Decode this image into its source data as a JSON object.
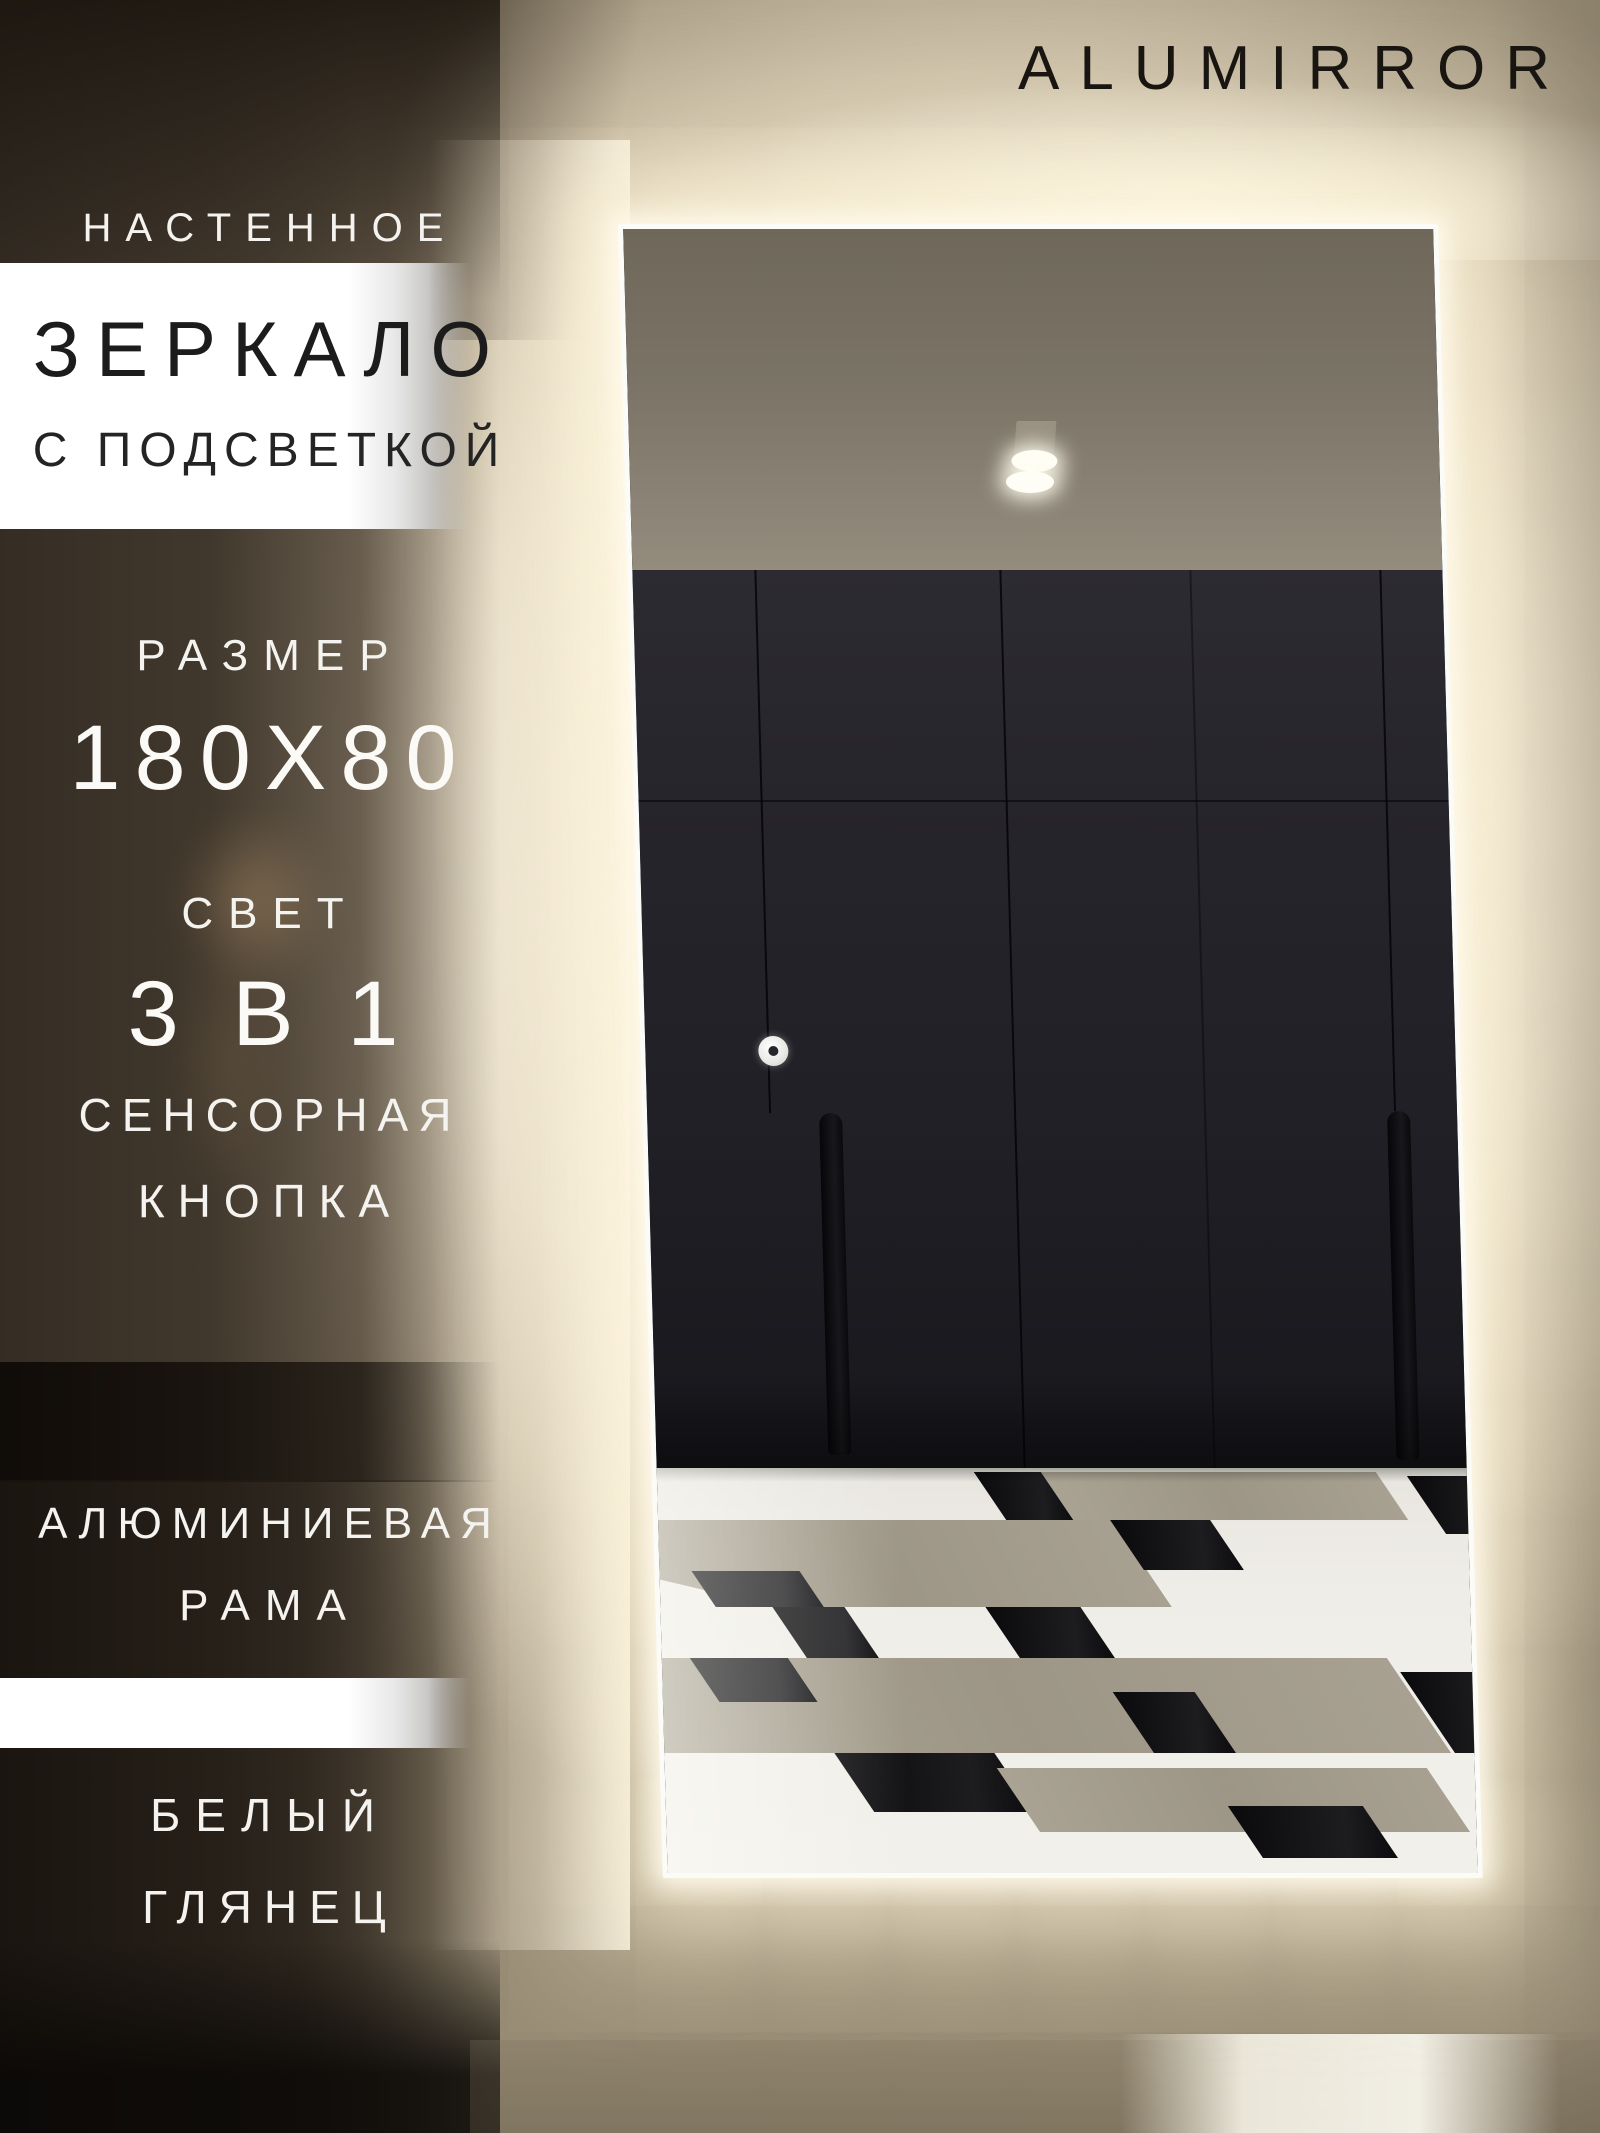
{
  "brand": {
    "name": "ALUMIRROR"
  },
  "labels": {
    "product_type": "НАСТЕННОЕ",
    "product_name": "ЗЕРКАЛО",
    "product_feature": "С ПОДСВЕТКОЙ",
    "size_label": "РАЗМЕР",
    "size_value": "180X80",
    "light_label": "СВЕТ",
    "light_value": "3 В 1",
    "touch_word1": "СЕНСОРНАЯ",
    "touch_word2": "КНОПКА",
    "frame_word1": "АЛЮМИНИЕВАЯ",
    "frame_word2": "РАМА",
    "finish_word1": "БЕЛЫЙ",
    "finish_word2": "ГЛЯНЕЦ"
  },
  "colors": {
    "led_glow": "#fdf3da",
    "mirror_frame": "#fbfbf8",
    "wardrobe_dark": "#232228",
    "ceiling_taupe": "#8d8577",
    "floor_gray": "#a59e8e",
    "floor_black": "#0b0b0e",
    "band_white": "#ffffff",
    "text_dark": "#1c1c1c",
    "text_light": "#f5f3ef",
    "brand_text": "#191511"
  }
}
